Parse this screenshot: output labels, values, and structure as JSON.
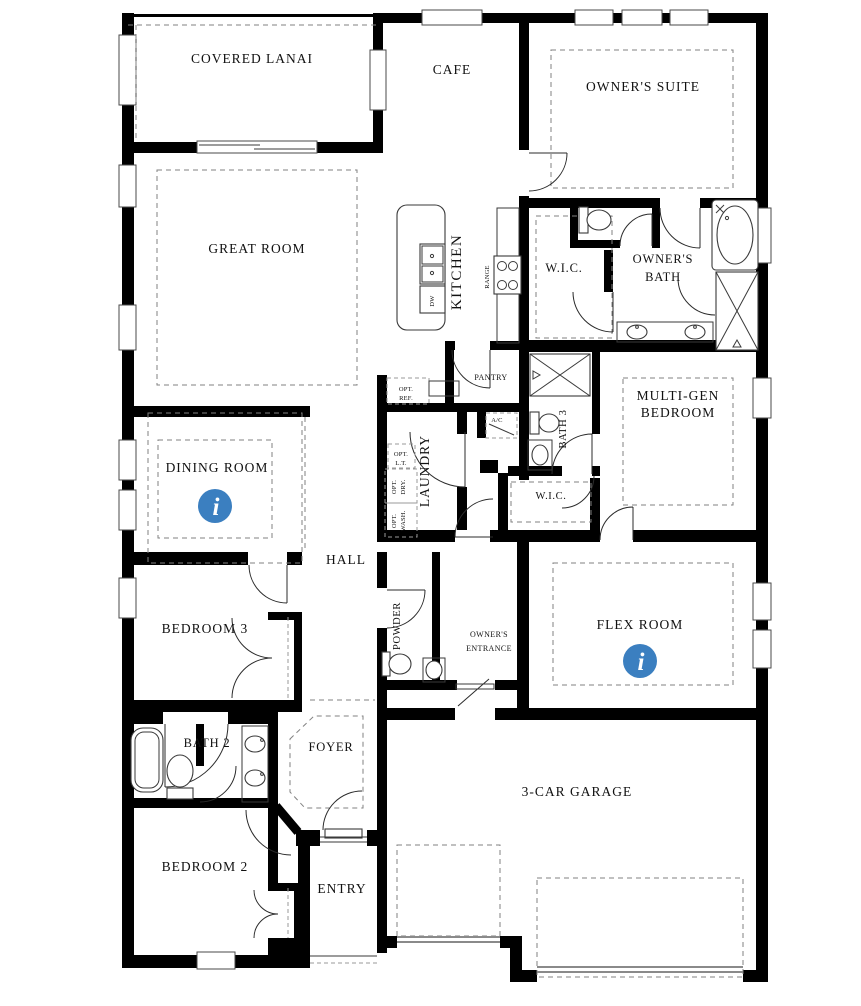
{
  "colors": {
    "wall": "#000000",
    "info_icon": "#3b7fc0",
    "dash": "#828282"
  },
  "rooms": {
    "covered_lanai": "COVERED LANAI",
    "cafe": "CAFE",
    "owners_suite": "OWNER'S SUITE",
    "great_room": "GREAT ROOM",
    "kitchen": "KITCHEN",
    "owners_wic": "W.I.C.",
    "owners_bath_line1": "OWNER'S",
    "owners_bath_line2": "BATH",
    "multi_gen_line1": "MULTI-GEN",
    "multi_gen_line2": "BEDROOM",
    "bath_3": "BATH 3",
    "multi_gen_wic": "W.I.C.",
    "dining_room": "DINING ROOM",
    "laundry": "LAUNDRY",
    "hall": "HALL",
    "bedroom_3": "BEDROOM 3",
    "powder": "POWDER",
    "owners_entrance_line1": "OWNER'S",
    "owners_entrance_line2": "ENTRANCE",
    "flex_room": "FLEX ROOM",
    "bath_2": "BATH 2",
    "foyer": "FOYER",
    "bedroom_2": "BEDROOM 2",
    "entry": "ENTRY",
    "garage": "3-CAR GARAGE"
  },
  "fixtures": {
    "range": "RANGE",
    "dishwasher": "DW",
    "pantry": "PANTRY",
    "opt_ref_line1": "OPT.",
    "opt_ref_line2": "REF.",
    "ac": "A/C",
    "opt_lt_line1": "OPT.",
    "opt_lt_line2": "L.T.",
    "opt_dry_line1": "OPT.",
    "opt_dry_line2": "DRY.",
    "opt_wash_line1": "OPT.",
    "opt_wash_line2": "WASH."
  },
  "icons": {
    "info_glyph": "i"
  }
}
